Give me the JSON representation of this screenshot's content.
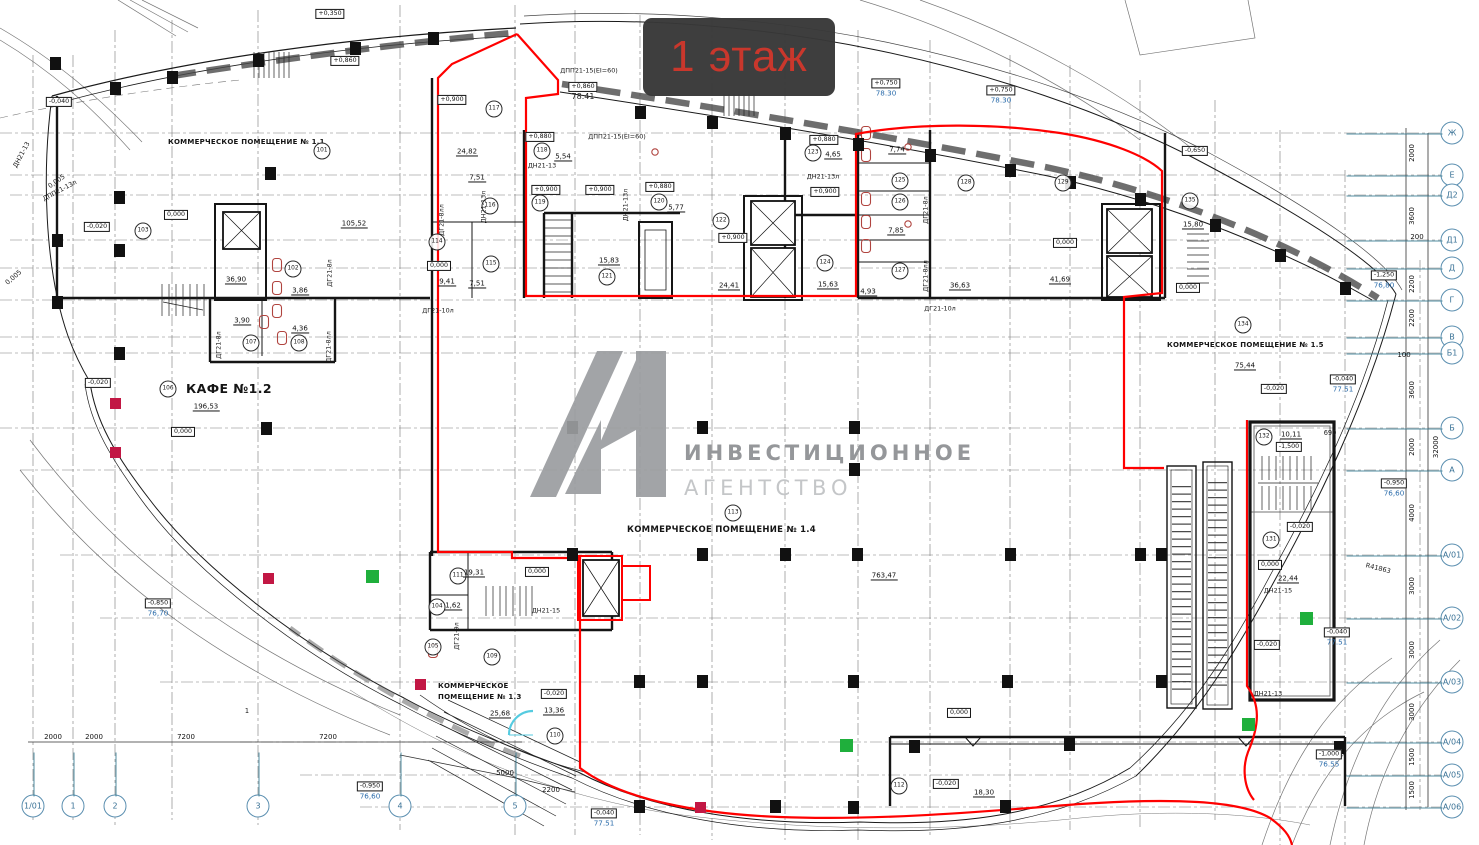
{
  "header": {
    "floor_badge": "1 этаж"
  },
  "watermark": {
    "logo": "А1",
    "line1": "ИНВЕСТИЦИОННОЕ",
    "line2": "АГЕНТСТВО"
  },
  "colors": {
    "boundary_red": "#ff0000",
    "badge_bg": "#383838",
    "badge_text": "#c9372c",
    "axis_blue": "#3a7296",
    "elevation_blue": "#2b6cab",
    "green_marker": "#1faf3c",
    "crimson_marker": "#c21744",
    "watermark_gray": "#9b9da0"
  },
  "plan": {
    "room_names": [
      {
        "t": "КОММЕРЧЕСКОЕ ПОМЕЩЕНИЕ № 1.1",
        "x": 168,
        "y": 142,
        "cls": "la"
      },
      {
        "t": "КАФЕ №1.2",
        "x": 186,
        "y": 389,
        "cls": "la s13"
      },
      {
        "t": "КОММЕРЧЕСКОЕ",
        "x": 438,
        "y": 686,
        "cls": "la"
      },
      {
        "t": "ПОМЕЩЕНИЕ № 1.3",
        "x": 438,
        "y": 697,
        "cls": "la"
      },
      {
        "t": "КОММЕРЧЕСКОЕ ПОМЕЩЕНИЕ № 1.4",
        "x": 627,
        "y": 531,
        "cls": "la s9"
      },
      {
        "t": "КОММЕРЧЕСКОЕ ПОМЕЩЕНИЕ № 1.5",
        "x": 1167,
        "y": 345,
        "cls": "la"
      }
    ],
    "room_circles": [
      {
        "n": "101",
        "x": 322,
        "y": 151
      },
      {
        "n": "102",
        "x": 293,
        "y": 269
      },
      {
        "n": "103",
        "x": 143,
        "y": 231
      },
      {
        "n": "104",
        "x": 437,
        "y": 607
      },
      {
        "n": "105",
        "x": 433,
        "y": 647
      },
      {
        "n": "106",
        "x": 168,
        "y": 389
      },
      {
        "n": "107",
        "x": 251,
        "y": 343
      },
      {
        "n": "108",
        "x": 299,
        "y": 343
      },
      {
        "n": "109",
        "x": 492,
        "y": 657
      },
      {
        "n": "110",
        "x": 555,
        "y": 736
      },
      {
        "n": "111",
        "x": 458,
        "y": 576
      },
      {
        "n": "112",
        "x": 899,
        "y": 786
      },
      {
        "n": "113",
        "x": 733,
        "y": 513
      },
      {
        "n": "114",
        "x": 437,
        "y": 242
      },
      {
        "n": "115",
        "x": 491,
        "y": 264
      },
      {
        "n": "116",
        "x": 490,
        "y": 206
      },
      {
        "n": "117",
        "x": 494,
        "y": 109
      },
      {
        "n": "118",
        "x": 542,
        "y": 151
      },
      {
        "n": "119",
        "x": 540,
        "y": 203
      },
      {
        "n": "120",
        "x": 659,
        "y": 202
      },
      {
        "n": "121",
        "x": 607,
        "y": 277
      },
      {
        "n": "122",
        "x": 721,
        "y": 221
      },
      {
        "n": "123",
        "x": 813,
        "y": 153
      },
      {
        "n": "124",
        "x": 825,
        "y": 263
      },
      {
        "n": "125",
        "x": 900,
        "y": 181
      },
      {
        "n": "126",
        "x": 900,
        "y": 202
      },
      {
        "n": "127",
        "x": 900,
        "y": 271
      },
      {
        "n": "128",
        "x": 966,
        "y": 183
      },
      {
        "n": "129",
        "x": 1063,
        "y": 183
      },
      {
        "n": "131",
        "x": 1271,
        "y": 540
      },
      {
        "n": "132",
        "x": 1264,
        "y": 437
      },
      {
        "n": "134",
        "x": 1243,
        "y": 325
      },
      {
        "n": "135",
        "x": 1190,
        "y": 201
      }
    ],
    "areas": [
      {
        "v": "105,52",
        "x": 354,
        "y": 224
      },
      {
        "v": "36,90",
        "x": 236,
        "y": 280
      },
      {
        "v": "3,86",
        "x": 300,
        "y": 291
      },
      {
        "v": "3,90",
        "x": 242,
        "y": 321
      },
      {
        "v": "4,36",
        "x": 300,
        "y": 329
      },
      {
        "v": "196,53",
        "x": 206,
        "y": 407
      },
      {
        "v": "24,82",
        "x": 467,
        "y": 152
      },
      {
        "v": "7,51",
        "x": 477,
        "y": 178
      },
      {
        "v": "9,41",
        "x": 447,
        "y": 282
      },
      {
        "v": "7,51",
        "x": 477,
        "y": 284
      },
      {
        "v": "5,54",
        "x": 563,
        "y": 157
      },
      {
        "v": "5,77",
        "x": 676,
        "y": 208
      },
      {
        "v": "15,83",
        "x": 609,
        "y": 261
      },
      {
        "v": "24,41",
        "x": 729,
        "y": 286
      },
      {
        "v": "4,65",
        "x": 833,
        "y": 155
      },
      {
        "v": "15,63",
        "x": 828,
        "y": 285
      },
      {
        "v": "7,74",
        "x": 897,
        "y": 150
      },
      {
        "v": "7,85",
        "x": 896,
        "y": 231
      },
      {
        "v": "4,93",
        "x": 868,
        "y": 292
      },
      {
        "v": "36,63",
        "x": 960,
        "y": 286
      },
      {
        "v": "41,69",
        "x": 1060,
        "y": 280
      },
      {
        "v": "15,80",
        "x": 1193,
        "y": 225
      },
      {
        "v": "75,44",
        "x": 1245,
        "y": 366
      },
      {
        "v": "10,11",
        "x": 1291,
        "y": 435
      },
      {
        "v": "22,44",
        "x": 1288,
        "y": 579
      },
      {
        "v": "19,31",
        "x": 474,
        "y": 573
      },
      {
        "v": "1,62",
        "x": 453,
        "y": 606
      },
      {
        "v": "25,68",
        "x": 500,
        "y": 714
      },
      {
        "v": "13,36",
        "x": 554,
        "y": 711
      },
      {
        "v": "18,30",
        "x": 984,
        "y": 793
      },
      {
        "v": "763,47",
        "x": 884,
        "y": 576
      }
    ],
    "elevations": [
      {
        "v": "-0,040",
        "x": 59,
        "y": 102
      },
      {
        "v": "+0,350",
        "x": 330,
        "y": 14
      },
      {
        "v": "+0,860",
        "x": 345,
        "y": 61
      },
      {
        "v": "+0,900",
        "x": 452,
        "y": 100
      },
      {
        "v": "+0,880",
        "x": 540,
        "y": 137
      },
      {
        "v": "+0,860",
        "x": 583,
        "y": 92,
        "sub": "78.41",
        "cls": "dk"
      },
      {
        "v": "+0,750",
        "x": 886,
        "y": 88,
        "sub": "78.30"
      },
      {
        "v": "+0,750",
        "x": 1001,
        "y": 95,
        "sub": "78.30"
      },
      {
        "v": "0,000",
        "x": 176,
        "y": 215
      },
      {
        "v": "-0,020",
        "x": 97,
        "y": 227
      },
      {
        "v": "-0,020",
        "x": 98,
        "y": 383
      },
      {
        "v": "0,000",
        "x": 183,
        "y": 432
      },
      {
        "v": "0,000",
        "x": 439,
        "y": 266
      },
      {
        "v": "+0,900",
        "x": 546,
        "y": 190
      },
      {
        "v": "+0,900",
        "x": 600,
        "y": 190
      },
      {
        "v": "+0,880",
        "x": 660,
        "y": 187
      },
      {
        "v": "+0,900",
        "x": 733,
        "y": 238
      },
      {
        "v": "+0,880",
        "x": 824,
        "y": 140
      },
      {
        "v": "+0,900",
        "x": 825,
        "y": 192
      },
      {
        "v": "0,000",
        "x": 1065,
        "y": 243
      },
      {
        "v": "-0,650",
        "x": 1195,
        "y": 151
      },
      {
        "v": "0,000",
        "x": 1188,
        "y": 288
      },
      {
        "v": "-0,020",
        "x": 1274,
        "y": 389
      },
      {
        "v": "-0,040",
        "x": 1343,
        "y": 384,
        "sub": "77.51"
      },
      {
        "v": "-1,250",
        "x": 1384,
        "y": 280,
        "sub": "76,80"
      },
      {
        "v": "-0,850",
        "x": 158,
        "y": 608,
        "sub": "76,70"
      },
      {
        "v": "0,000",
        "x": 537,
        "y": 572
      },
      {
        "v": "-0,020",
        "x": 554,
        "y": 694
      },
      {
        "v": "0,000",
        "x": 959,
        "y": 713
      },
      {
        "v": "-0,020",
        "x": 946,
        "y": 784
      },
      {
        "v": "-0,950",
        "x": 370,
        "y": 791,
        "sub": "76,60"
      },
      {
        "v": "-0,950",
        "x": 1394,
        "y": 488,
        "sub": "76,60"
      },
      {
        "v": "-0,040",
        "x": 604,
        "y": 818,
        "sub": "77.51"
      },
      {
        "v": "-0,040",
        "x": 1337,
        "y": 637,
        "sub": "77.51"
      },
      {
        "v": "-1,000",
        "x": 1329,
        "y": 759,
        "sub": "76.55"
      },
      {
        "v": "-1,500",
        "x": 1289,
        "y": 447
      },
      {
        "v": "-0,020",
        "x": 1300,
        "y": 527
      },
      {
        "v": "0,000",
        "x": 1270,
        "y": 565
      },
      {
        "v": "-0,020",
        "x": 1267,
        "y": 645
      }
    ],
    "door_tags": [
      {
        "t": "ДПП21-15(EI=60)",
        "x": 589,
        "y": 71
      },
      {
        "t": "ДПП21-15(EI=60)",
        "x": 617,
        "y": 137
      },
      {
        "t": "ДН21-13",
        "x": 542,
        "y": 166
      },
      {
        "t": "ДН21-13л",
        "x": 484,
        "y": 207,
        "rot": -90
      },
      {
        "t": "ДН21-13л",
        "x": 626,
        "y": 205,
        "rot": -90
      },
      {
        "t": "ДН21-13л",
        "x": 823,
        "y": 177
      },
      {
        "t": "ДГ21-8лл",
        "x": 442,
        "y": 220,
        "rot": -90
      },
      {
        "t": "ДГ21-8л",
        "x": 330,
        "y": 273,
        "rot": -90
      },
      {
        "t": "ДГ21-8л",
        "x": 219,
        "y": 345,
        "rot": -90
      },
      {
        "t": "ДГ21-8лл",
        "x": 329,
        "y": 347,
        "rot": -90
      },
      {
        "t": "ДГ21-8л",
        "x": 926,
        "y": 210,
        "rot": -90
      },
      {
        "t": "ДГ21-8лл",
        "x": 926,
        "y": 276,
        "rot": -90
      },
      {
        "t": "ДГ21-10л",
        "x": 438,
        "y": 311
      },
      {
        "t": "ДГ21-10л",
        "x": 940,
        "y": 309
      },
      {
        "t": "ДГ21-9л",
        "x": 457,
        "y": 636,
        "rot": -90
      },
      {
        "t": "ДН21-15",
        "x": 546,
        "y": 611
      },
      {
        "t": "ДН21-15",
        "x": 1278,
        "y": 591
      },
      {
        "t": "ДН21-13",
        "x": 1268,
        "y": 694
      },
      {
        "t": "ДН21-13",
        "x": 22,
        "y": 155,
        "rot": -62
      },
      {
        "t": "ДПП21-13л",
        "x": 60,
        "y": 191,
        "rot": -28
      }
    ],
    "misc_labels": [
      {
        "t": "R41863",
        "x": 1378,
        "y": 569,
        "rot": 14
      },
      {
        "t": "0,005",
        "x": 57,
        "y": 182,
        "rot": -35
      },
      {
        "t": "0,005",
        "x": 14,
        "y": 278,
        "rot": -40
      },
      {
        "t": "690",
        "x": 1330,
        "y": 434
      },
      {
        "t": "1",
        "x": 247,
        "y": 712
      }
    ]
  },
  "axes": {
    "right": [
      {
        "label": "Ж",
        "x": 1452,
        "y": 133
      },
      {
        "label": "Е",
        "x": 1452,
        "y": 175
      },
      {
        "label": "Д2",
        "x": 1452,
        "y": 195
      },
      {
        "label": "Д1",
        "x": 1452,
        "y": 240
      },
      {
        "label": "Д",
        "x": 1452,
        "y": 268
      },
      {
        "label": "Г",
        "x": 1452,
        "y": 300
      },
      {
        "label": "В",
        "x": 1452,
        "y": 337
      },
      {
        "label": "Б1",
        "x": 1452,
        "y": 353
      },
      {
        "label": "Б",
        "x": 1452,
        "y": 428
      },
      {
        "label": "А",
        "x": 1452,
        "y": 470
      },
      {
        "label": "А/01",
        "x": 1452,
        "y": 555
      },
      {
        "label": "А/02",
        "x": 1452,
        "y": 618
      },
      {
        "label": "А/03",
        "x": 1452,
        "y": 682
      },
      {
        "label": "А/04",
        "x": 1452,
        "y": 742
      },
      {
        "label": "А/05",
        "x": 1452,
        "y": 775
      },
      {
        "label": "А/06",
        "x": 1452,
        "y": 807
      }
    ],
    "bottom": [
      {
        "label": "1/01",
        "x": 33,
        "y": 806
      },
      {
        "label": "1",
        "x": 73,
        "y": 806
      },
      {
        "label": "2",
        "x": 115,
        "y": 806
      },
      {
        "label": "3",
        "x": 258,
        "y": 806
      },
      {
        "label": "4",
        "x": 400,
        "y": 806
      },
      {
        "label": "5",
        "x": 515,
        "y": 806
      }
    ],
    "dims_right": [
      {
        "v": "2000",
        "x": 1412,
        "y": 153,
        "rot": -90
      },
      {
        "v": "3600",
        "x": 1412,
        "y": 216,
        "rot": -90
      },
      {
        "v": "200",
        "x": 1417,
        "y": 237
      },
      {
        "v": "2200",
        "x": 1412,
        "y": 284,
        "rot": -90
      },
      {
        "v": "2200",
        "x": 1412,
        "y": 318,
        "rot": -90
      },
      {
        "v": "100",
        "x": 1404,
        "y": 355
      },
      {
        "v": "3600",
        "x": 1412,
        "y": 390,
        "rot": -90
      },
      {
        "v": "2000",
        "x": 1412,
        "y": 447,
        "rot": -90
      },
      {
        "v": "32000",
        "x": 1436,
        "y": 447,
        "rot": -90
      },
      {
        "v": "4000",
        "x": 1412,
        "y": 513,
        "rot": -90
      },
      {
        "v": "3000",
        "x": 1412,
        "y": 586,
        "rot": -90
      },
      {
        "v": "3000",
        "x": 1412,
        "y": 650,
        "rot": -90
      },
      {
        "v": "3000",
        "x": 1412,
        "y": 712,
        "rot": -90
      },
      {
        "v": "1500",
        "x": 1412,
        "y": 757,
        "rot": -90
      },
      {
        "v": "1500",
        "x": 1412,
        "y": 790,
        "rot": -90
      }
    ],
    "dims_bottom": [
      {
        "v": "2000",
        "x": 53,
        "y": 737
      },
      {
        "v": "2000",
        "x": 94,
        "y": 737
      },
      {
        "v": "7200",
        "x": 186,
        "y": 737
      },
      {
        "v": "7200",
        "x": 328,
        "y": 737
      },
      {
        "v": "5000",
        "x": 505,
        "y": 773
      },
      {
        "v": "2200",
        "x": 551,
        "y": 790
      }
    ]
  }
}
